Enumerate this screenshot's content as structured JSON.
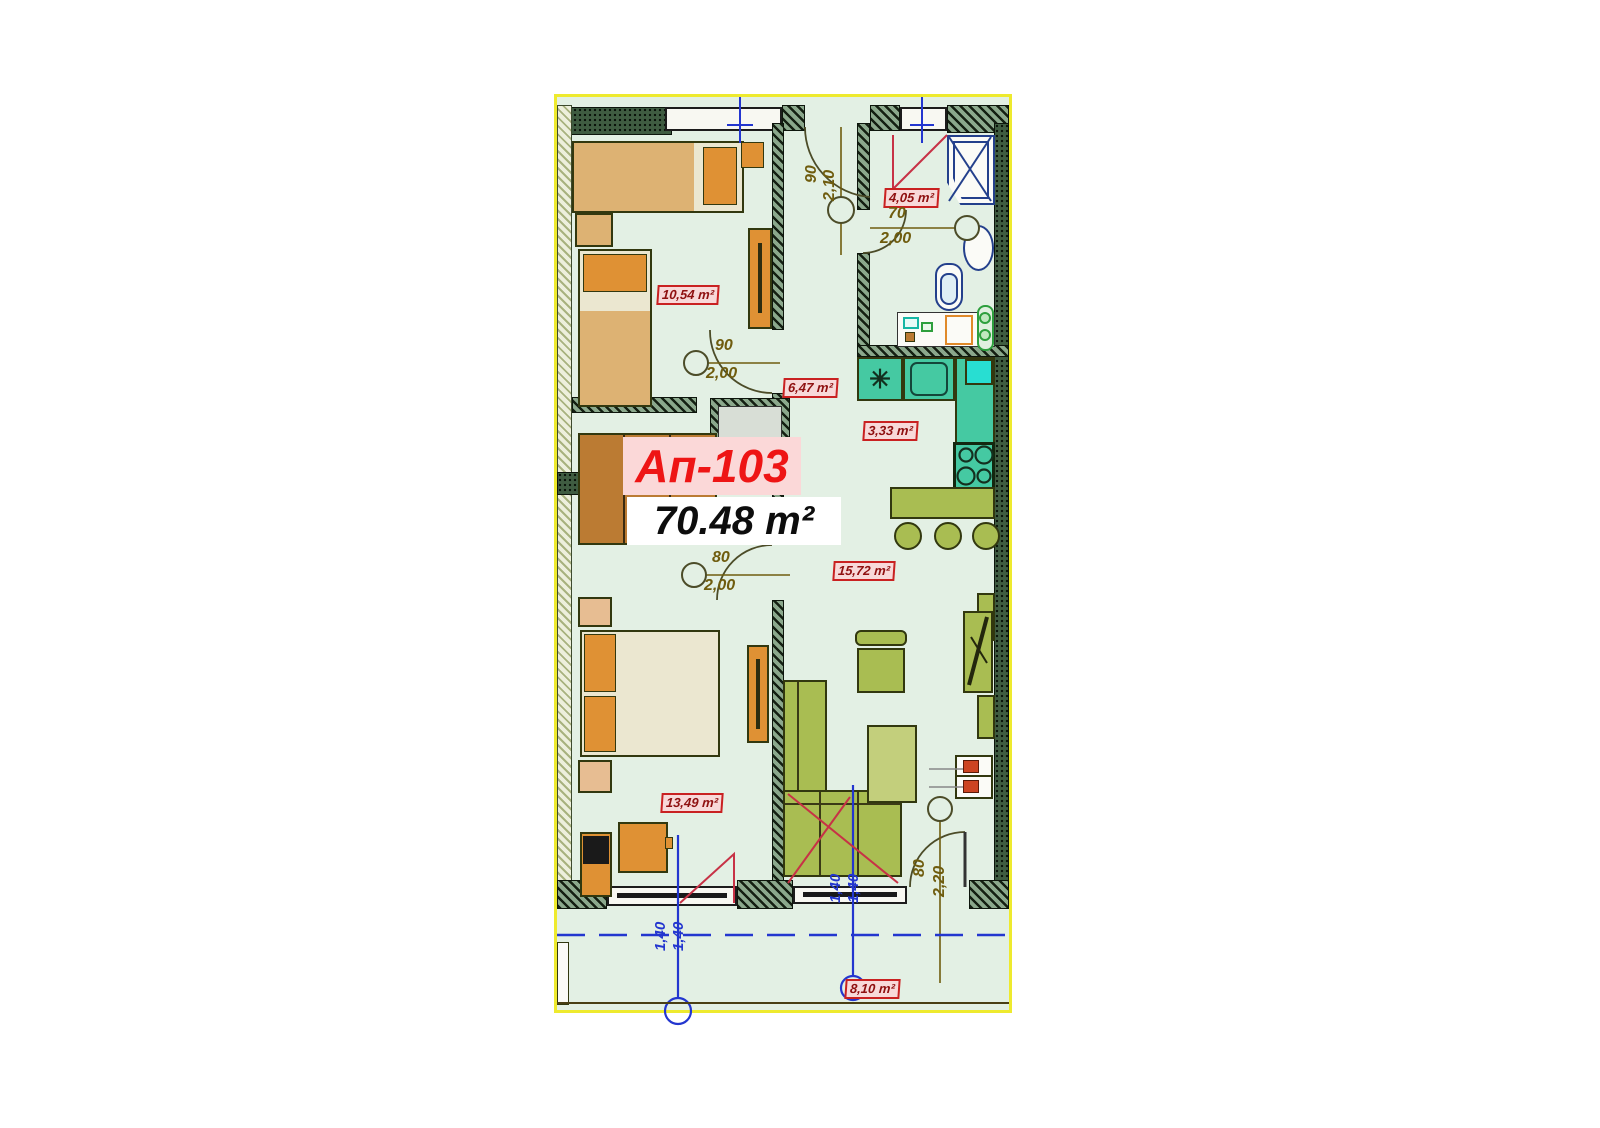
{
  "plan": {
    "unit_label": "Ап-103",
    "total_area": "70.48 m²",
    "rooms": {
      "bedroom1": "10,54 m²",
      "hallway": "6,47 m²",
      "bathroom": "4,05 m²",
      "kitchen": "3,33 m²",
      "living_room": "15,72 m²",
      "bedroom2": "13,49 m²",
      "terrace": "8,10 m²"
    },
    "doors": {
      "entrance": {
        "w": "90",
        "h": "2,10"
      },
      "bathroom": {
        "w": "70",
        "h": "2,00"
      },
      "bedroom1": {
        "w": "90",
        "h": "2,00"
      },
      "bedroom2": {
        "w": "80",
        "h": "2,00"
      },
      "terrace": {
        "w": "80",
        "h": "2,20"
      }
    },
    "axes": {
      "a1": "1,40",
      "a2": "1,40",
      "b1": "1,40",
      "b2": "1,40"
    },
    "icons": {
      "fridge": "✳"
    },
    "colors": {
      "label_red": "#c92121",
      "label_bg": "#f8d9d9",
      "unit_red": "#ee1515",
      "dim_brown": "#6f5c0e",
      "axis_blue": "#2336cf",
      "plan_bg": "#e3f0e4",
      "kitchen_teal": "#45c9a2",
      "furniture_olive": "#a9bd52",
      "wood_orange": "#df9134",
      "outline_yellow": "#eeea2e"
    }
  }
}
